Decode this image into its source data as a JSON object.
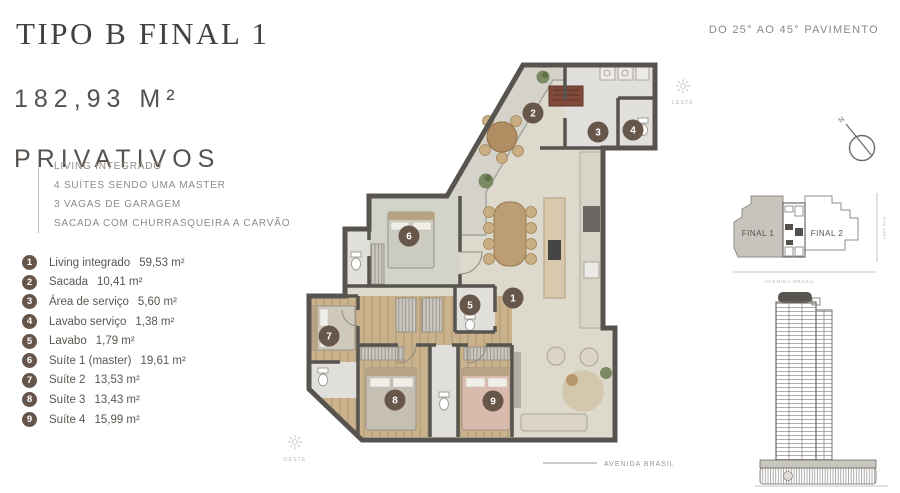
{
  "header": {
    "title": "TIPO B FINAL 1",
    "area_value": "182,93 M²",
    "area_label": "PRIVATIVOS",
    "pavement_note": "DO 25° AO 45° PAVIMENTO"
  },
  "features": [
    "LIVING INTEGRADO",
    "4 SUÍTES SENDO UMA MASTER",
    "3 VAGAS DE GARAGEM",
    "SACADA COM CHURRASQUEIRA A CARVÃO"
  ],
  "legend": [
    {
      "num": "1",
      "label": "Living integrado",
      "area": "59,53 m²"
    },
    {
      "num": "2",
      "label": "Sacada",
      "area": "10,41 m²"
    },
    {
      "num": "3",
      "label": "Área de serviço",
      "area": "5,60 m²"
    },
    {
      "num": "4",
      "label": "Lavabo serviço",
      "area": "1,38 m²"
    },
    {
      "num": "5",
      "label": "Lavabo",
      "area": "1,79 m²"
    },
    {
      "num": "6",
      "label": "Suíte 1 (master)",
      "area": "19,61 m²"
    },
    {
      "num": "7",
      "label": "Suíte 2",
      "area": "13,53 m²"
    },
    {
      "num": "8",
      "label": "Suíte 3",
      "area": "13,43 m²"
    },
    {
      "num": "9",
      "label": "Suíte 4",
      "area": "15,99 m²"
    }
  ],
  "plan": {
    "avenue_label": "AVENIDA BRASIL",
    "east_label": "LESTE",
    "west_label": "OESTE"
  },
  "compass": {
    "north_label": "N"
  },
  "keyplan": {
    "final1_label": "FINAL 1",
    "final2_label": "FINAL 2",
    "street_right_label": "RUA 1300",
    "street_bottom_label": "AVENIDA BRASIL"
  },
  "colors": {
    "accent_brown": "#66554a",
    "wall": "#575450",
    "wood": "#c9b28c"
  }
}
